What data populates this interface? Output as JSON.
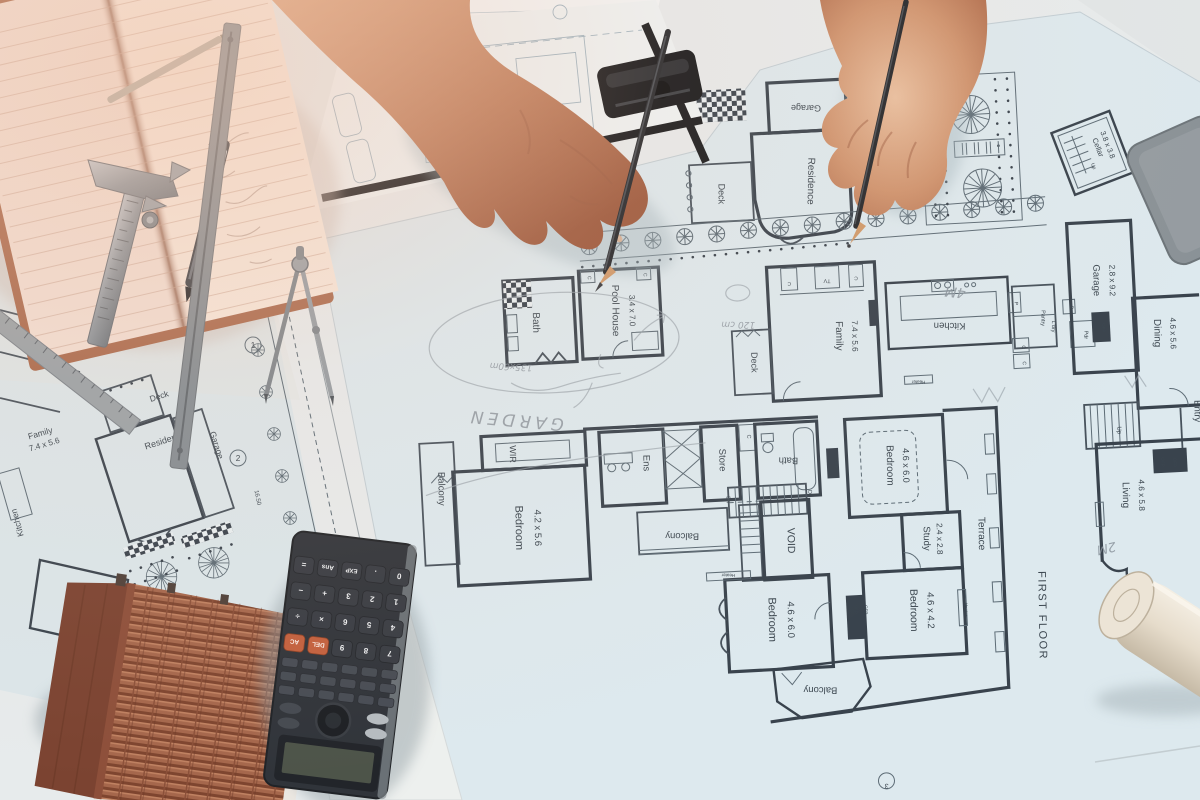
{
  "site_plan": {
    "deck": "Deck",
    "residence": "Residence",
    "garage": "Garage",
    "family": "Family",
    "family_dims": "7.4 x 5.6",
    "kitchen": "Kitchen",
    "garage_2": "Garage",
    "garage_2_dims": "2.8 x 9.2",
    "wir": "WIR",
    "marker_1": "1",
    "marker_2": "2",
    "road_dim": "16.50"
  },
  "ground_floor": {
    "garage": "Garage",
    "residence": "Residence",
    "deck": "Deck",
    "pool_house": "Pool House",
    "pool_house_dims": "3.4 x 7.0",
    "bath": "Bath",
    "family": "Family",
    "family_dims": "7.4 x 5.6",
    "deck_small": "Deck",
    "kitchen": "Kitchen",
    "pantry": "Pantry",
    "laundry": "L'dry",
    "powder": "Pdr",
    "garage_r": "Garage",
    "garage_r_dims": "2.8 x 9.2",
    "dining": "Dining",
    "dining_dims": "4.6 x 5.6",
    "entry": "Entry",
    "living": "Living",
    "living_dims": "4.6 x 5.8",
    "cellar": "Cellar",
    "cellar_dims": "3.8 x 3.8",
    "up": "Up",
    "dn": "Dn",
    "tv": "TV",
    "c": "C",
    "p": "P",
    "d": "D",
    "ofp": "OFP",
    "heater": "Heater"
  },
  "first_floor": {
    "title": "FIRST FLOOR",
    "balcony": "Balcony",
    "wir": "WIR",
    "bedroom_1": "Bedroom",
    "bedroom_1_dims": "4.2 x 5.6",
    "ens": "Ens",
    "store": "Store",
    "bath": "Bath",
    "void": "VOID",
    "bedroom_2": "Bedroom",
    "bedroom_2_dims": "4.6 x 6.0",
    "bedroom_3": "Bedroom",
    "bedroom_3_dims": "4.6 x 6.0",
    "bedroom_4": "Bedroom",
    "bedroom_4_dims": "4.6 x 4.2",
    "study": "Study",
    "study_dims": "2.4 x 2.8",
    "terrace": "Terrace",
    "marker_3": "3",
    "ofp": "OFP",
    "heater": "Heater",
    "dn": "Dn",
    "c": "C"
  },
  "handwriting": {
    "garden": "GARDEN",
    "note_size": "135x60m",
    "note_len": "120 cm",
    "note_4m": "4M",
    "note_2m": "2M"
  },
  "calculator": {
    "keys": [
      [
        "7",
        "8",
        "9",
        "DEL",
        "AC"
      ],
      [
        "4",
        "5",
        "6",
        "×",
        "÷"
      ],
      [
        "1",
        "2",
        "3",
        "+",
        "−"
      ],
      [
        "0",
        ".",
        "EXP",
        "Ans",
        "="
      ]
    ],
    "accent_color": "#c2603e"
  },
  "colors": {
    "table": "#e7ebec",
    "blueprint_paper": "#dde9ee",
    "plan_ink": "#39434d",
    "notebook_page": "#f3e1d7",
    "skin": "#c08163",
    "roof_tile": "#9e5c43",
    "calculator_body": "#30343a"
  }
}
